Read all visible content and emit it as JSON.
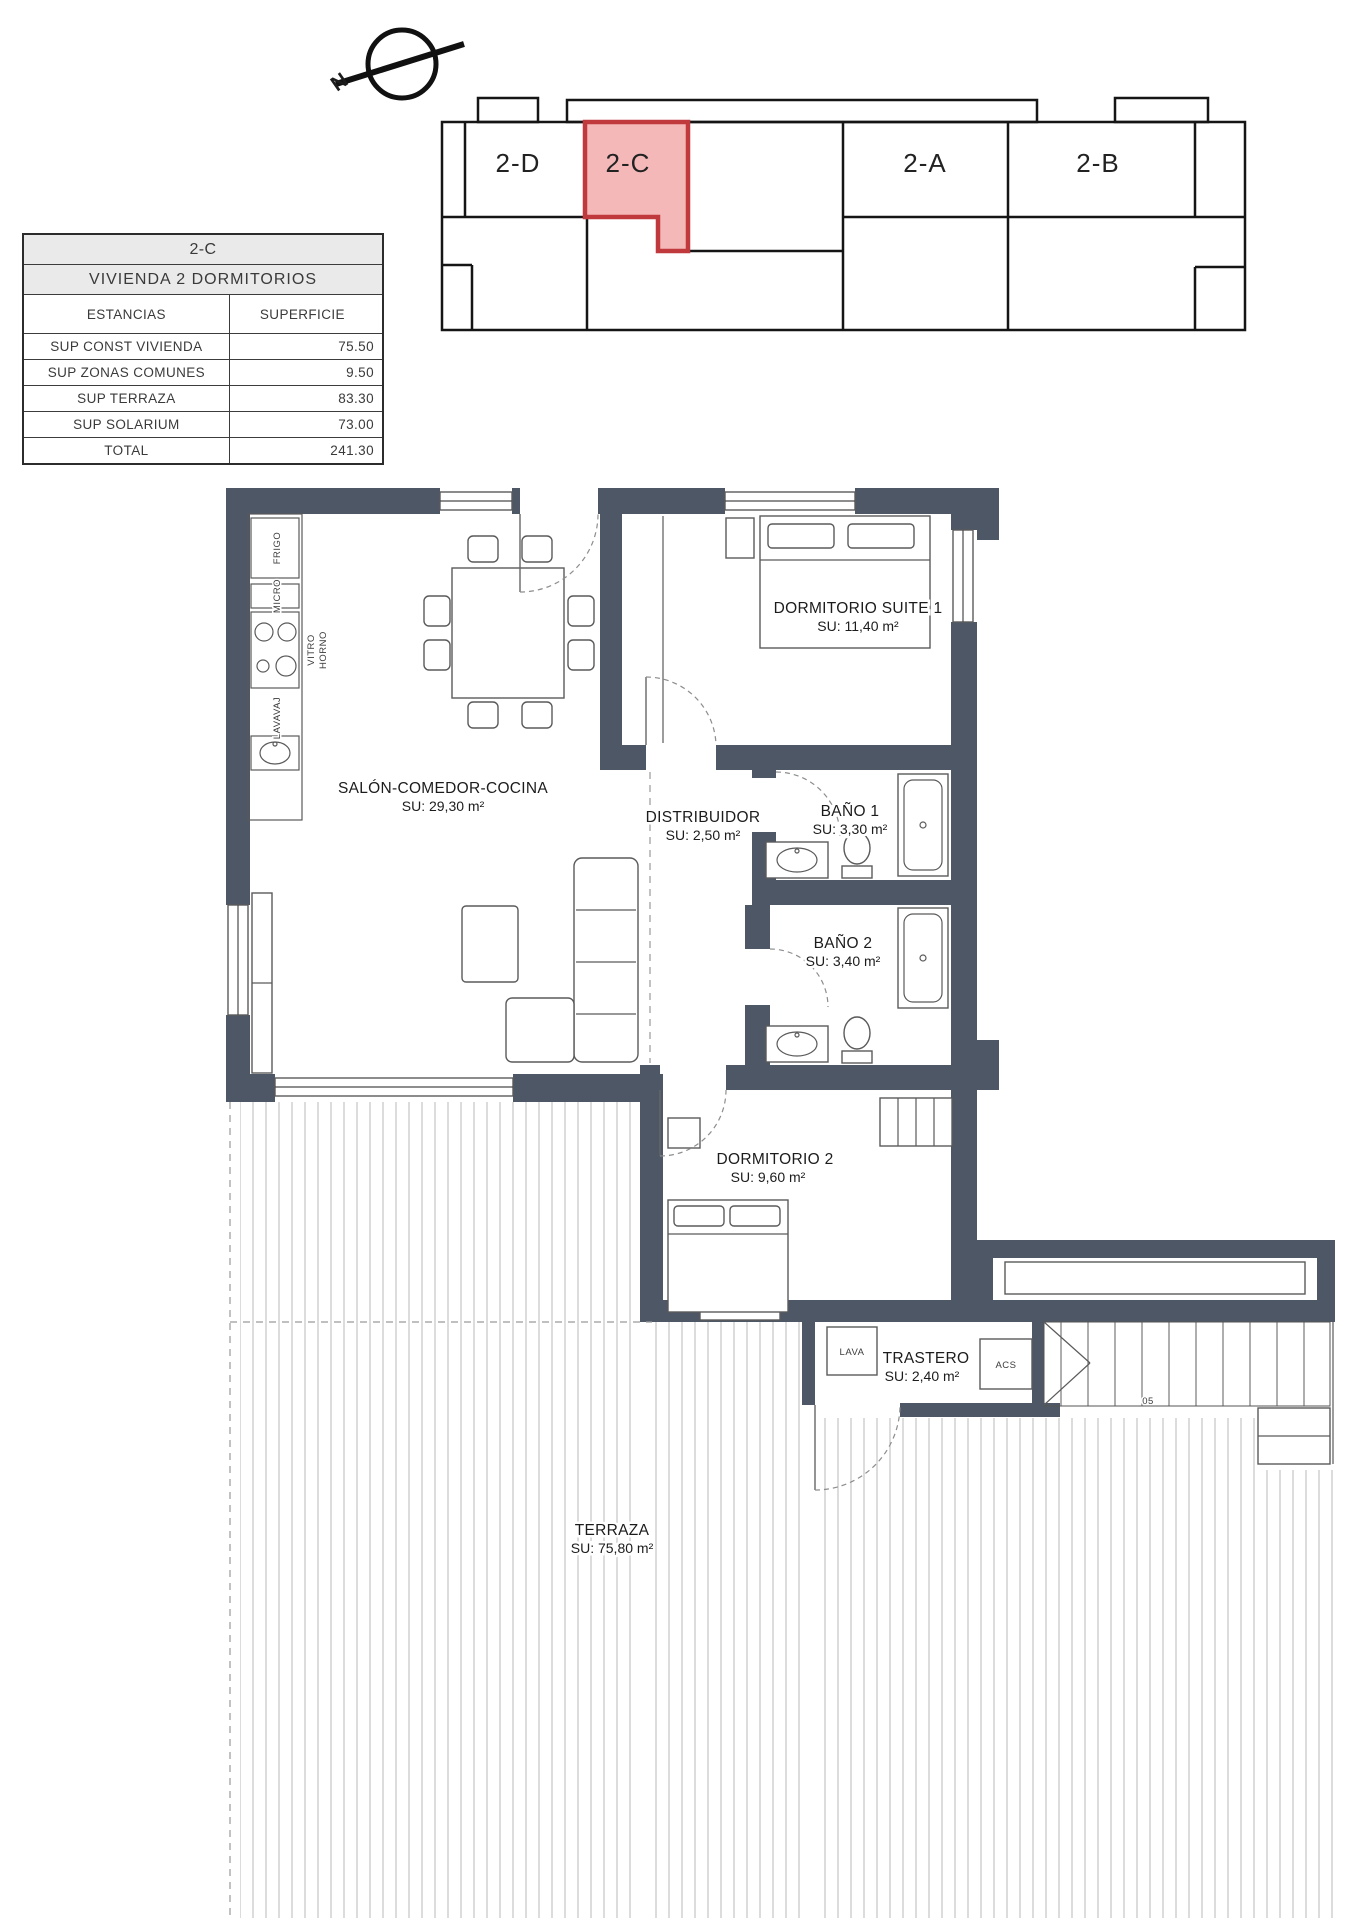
{
  "north": {
    "label": "N"
  },
  "key_plan": {
    "units": [
      {
        "label": "2-D"
      },
      {
        "label": "2-C"
      },
      {
        "label": "2-A"
      },
      {
        "label": "2-B"
      }
    ],
    "highlight_fill": "#f5b8b8",
    "highlight_stroke": "#c0393c"
  },
  "summary_table": {
    "title": "2-C",
    "subtitle": "VIVIENDA 2 DORMITORIOS",
    "headers": {
      "estancias": "ESTANCIAS",
      "superficie": "SUPERFICIE"
    },
    "rows": [
      {
        "label": "SUP CONST VIVIENDA",
        "value": "75.50"
      },
      {
        "label": "SUP ZONAS COMUNES",
        "value": "9.50"
      },
      {
        "label": "SUP TERRAZA",
        "value": "83.30"
      },
      {
        "label": "SUP SOLARIUM",
        "value": "73.00"
      },
      {
        "label": "TOTAL",
        "value": "241.30"
      }
    ]
  },
  "rooms": {
    "salon": {
      "name": "SALÓN-COMEDOR-COCINA",
      "area": "SU: 29,30 m²"
    },
    "suite": {
      "name": "DORMITORIO SUITE 1",
      "area": "SU: 11,40 m²"
    },
    "distribuidor": {
      "name": "DISTRIBUIDOR",
      "area": "SU: 2,50 m²"
    },
    "bano1": {
      "name": "BAÑO 1",
      "area": "SU: 3,30 m²"
    },
    "bano2": {
      "name": "BAÑO 2",
      "area": "SU: 3,40 m²"
    },
    "dorm2": {
      "name": "DORMITORIO 2",
      "area": "SU: 9,60 m²"
    },
    "trastero": {
      "name": "TRASTERO",
      "area": "SU: 2,40 m²"
    },
    "terraza": {
      "name": "TERRAZA",
      "area": "SU: 75,80 m²"
    }
  },
  "appliances": {
    "frigo": "FRIGO",
    "micro": "MICRO",
    "vitro": "VITRO",
    "horno": "HORNO",
    "lavavaj": "LAVAVAJ",
    "lava": "LAVA",
    "acs": "ACS"
  },
  "stairs": {
    "step_label": "05"
  },
  "colors": {
    "wall": "#4d5765",
    "hatch": "#b8b8b8"
  }
}
